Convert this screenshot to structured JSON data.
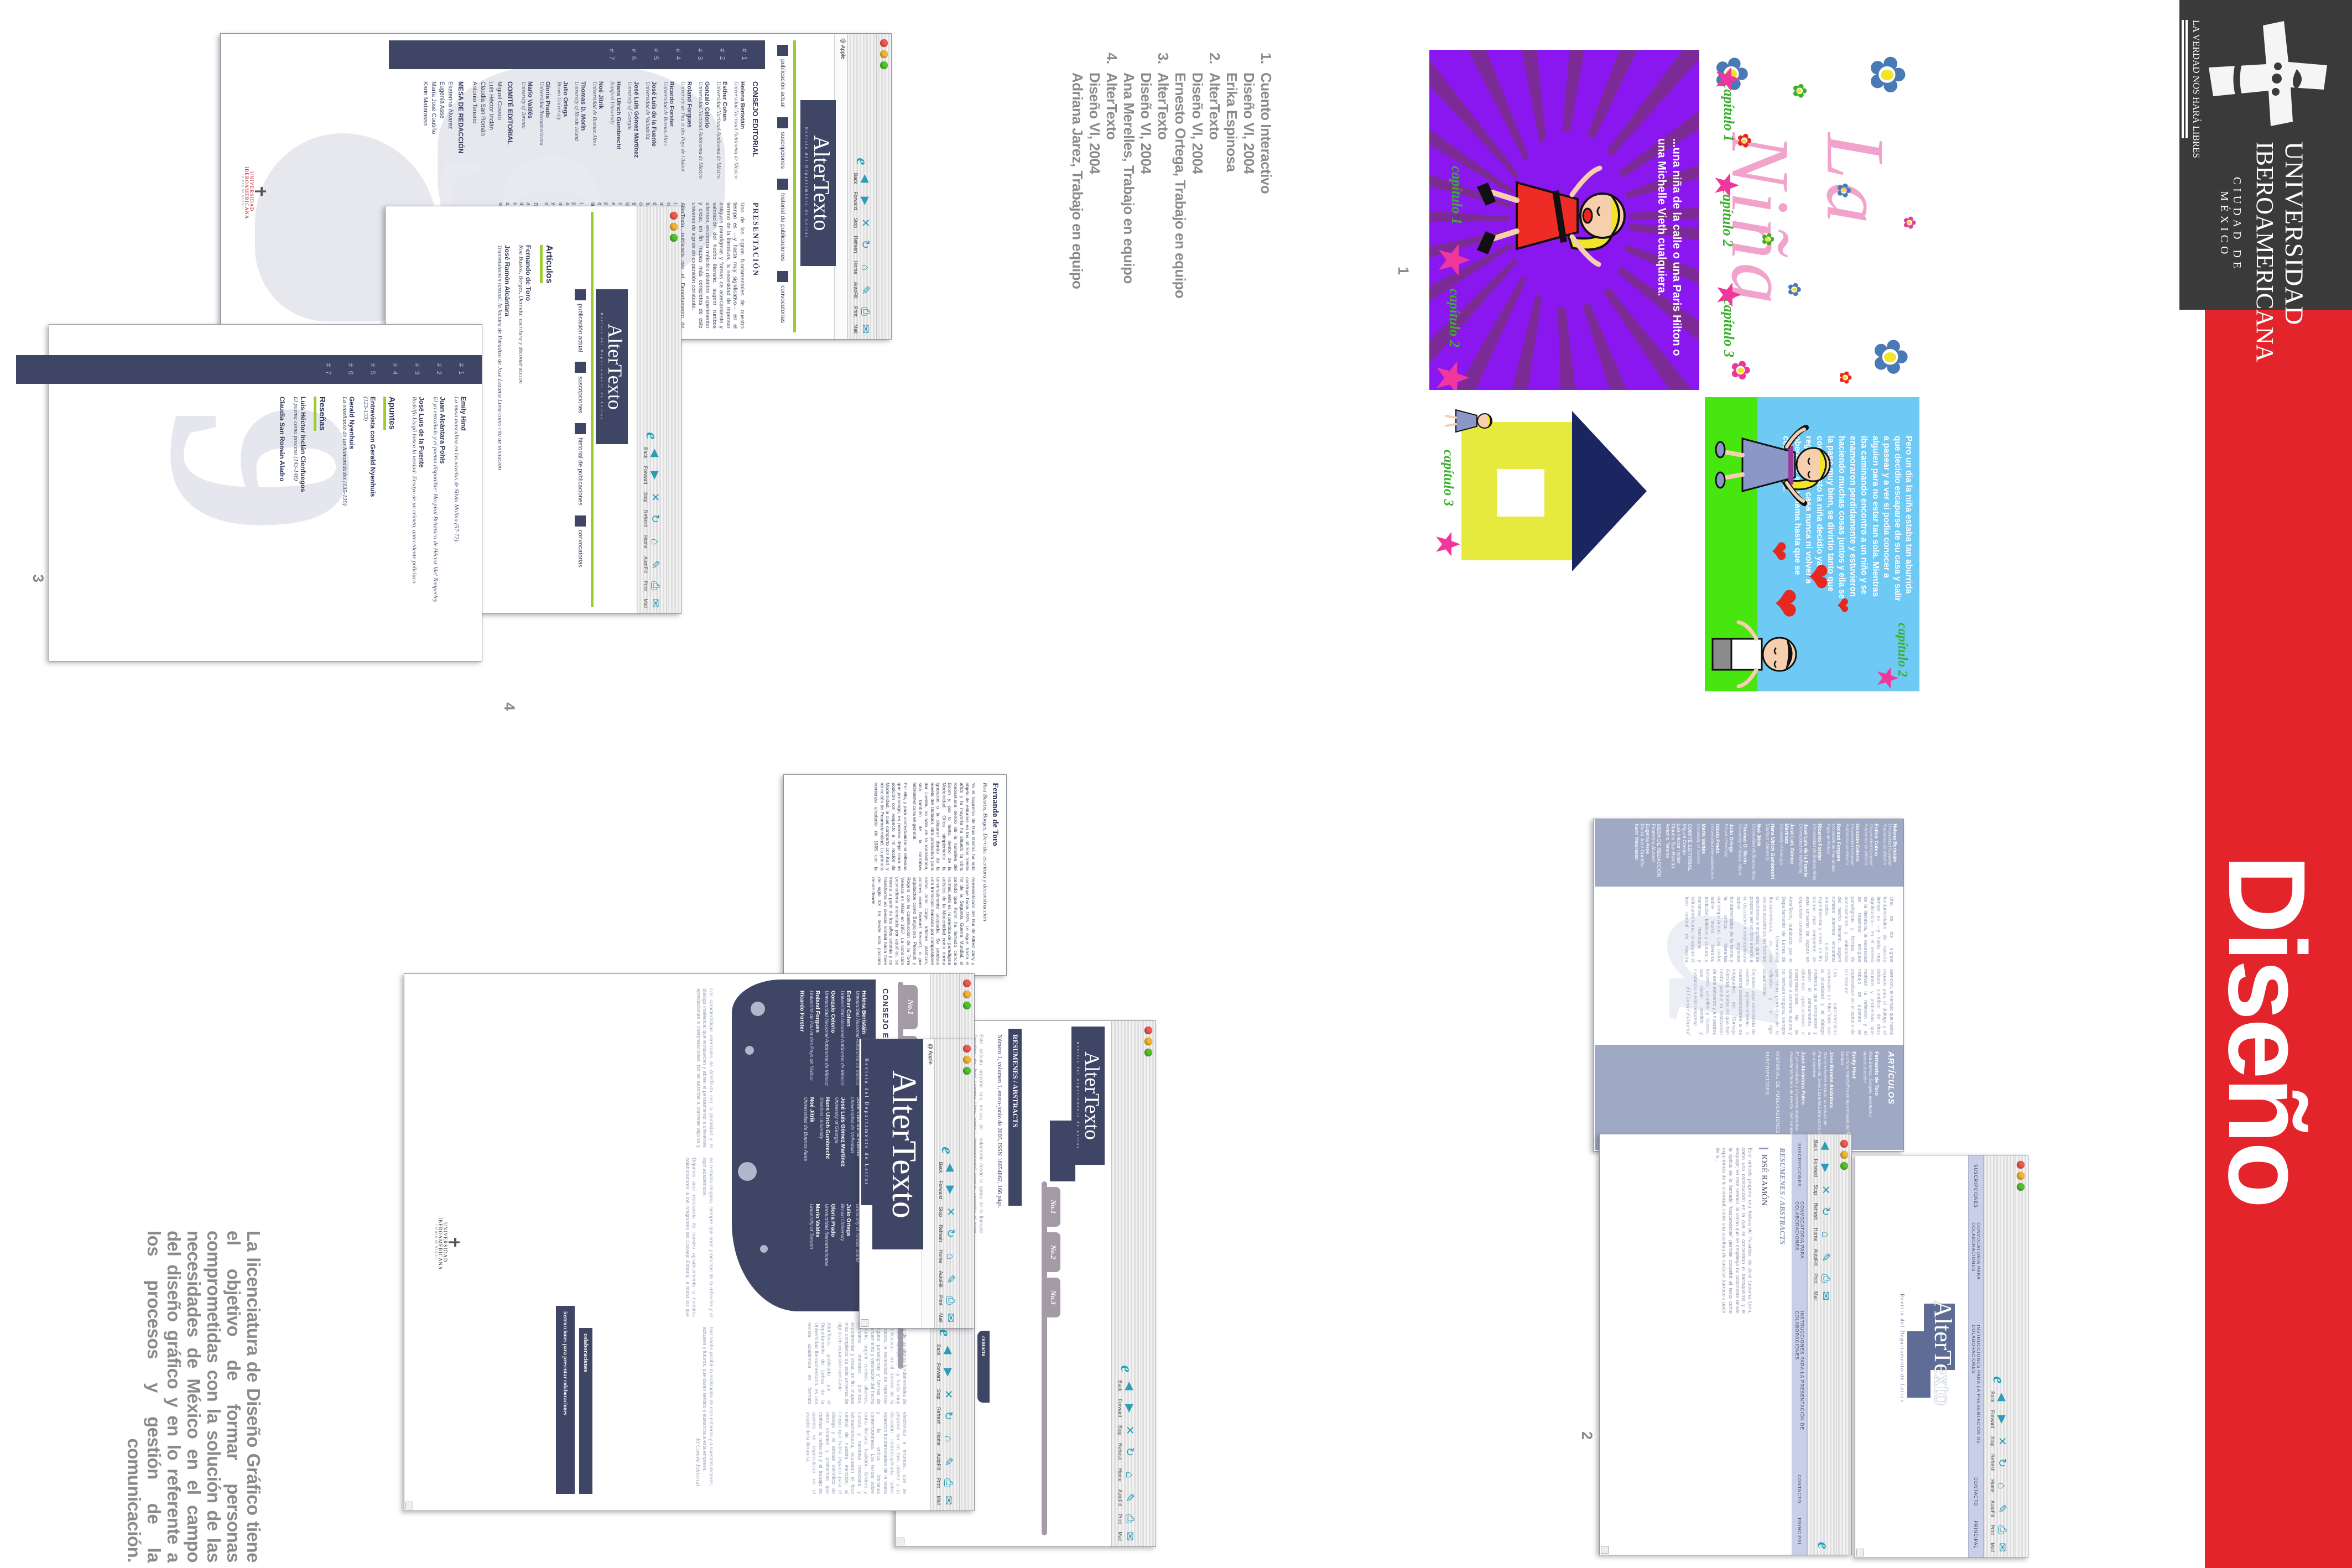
{
  "banner": {
    "motto": "LA VERDAD NOS HARÁ LIBRES",
    "univ1": "UNIVERSIDAD",
    "univ2": "IBEROAMERICANA",
    "city": "CIUDAD DE MÉXICO",
    "title": "Diseño Gráfico",
    "red": "#e3242b",
    "black": "#3a3a3a"
  },
  "markers": {
    "p1": "1",
    "p2": "2",
    "p3": "3",
    "p4": "4"
  },
  "project_list": [
    {
      "n": "1.",
      "t": "Cuento Interactivo"
    },
    {
      "n": "",
      "t": "Diseño VI, 2004"
    },
    {
      "n": "",
      "t": "Erika Espinosa"
    },
    {
      "n": "2.",
      "t": "AlterTexto"
    },
    {
      "n": "",
      "t": "Diseño VI, 2004"
    },
    {
      "n": "",
      "t": "Ernesto Ortega, Trabajo en equipo"
    },
    {
      "n": "3.",
      "t": "AlterTexto"
    },
    {
      "n": "",
      "t": "Diseño VI, 2004"
    },
    {
      "n": "",
      "t": "Ana Merelles, Trabajo en equipo"
    },
    {
      "n": "4.",
      "t": "AlterTexto"
    },
    {
      "n": "",
      "t": "Diseño VI, 2004"
    },
    {
      "n": "",
      "t": "Adriana Jarez, Trabajo en equipo"
    }
  ],
  "footer": "La licenciatura de Diseño Gráfico tiene el objetivo de formar personas comprometidas con la solución de las necesidades de México en el campo del diseño gráfico y en lo referente a los procesos y gestión de la comunicación.",
  "illustrations": {
    "la_nina": {
      "title": "La Niña",
      "chapters": [
        "capítulo 1",
        "capítulo 2",
        "capítulo 3"
      ]
    },
    "purple": {
      "caption": "...una niña de la calle o una Paris Hilton o una Michelle Vieth cualquiera.",
      "chapters": [
        "capítulo 1",
        "capítulo 2"
      ]
    },
    "house": {
      "chapter": "capítulo 3"
    },
    "kids": {
      "chapter": "capítulo 2",
      "story": "Pero un dia la niña estaba tan aburrida que decidio escaparse de su casa y salir a pasear y a ver si podia conocer a alguien para no estar tan sola. Mientras iba caminando encontro a un niño y se enamoraron perdidamente y estuvieron haciendo muchas cosas juntos y ella se la paso muy bien, se divirtio tanto que con todo esto la niña decidio ya no regresar a su casa nunca ni volver a obedecer a su mama hasta que se convirtio en..."
    }
  },
  "browser": {
    "toolbar": [
      {
        "icon": "◀",
        "label": "Back"
      },
      {
        "icon": "▶",
        "label": "Forward"
      },
      {
        "icon": "✕",
        "label": "Stop"
      },
      {
        "icon": "↻",
        "label": "Refresh"
      },
      {
        "icon": "⌂",
        "label": "Home"
      },
      {
        "icon": "✎",
        "label": "AutoFill"
      },
      {
        "icon": "⎙",
        "label": "Print"
      },
      {
        "icon": "✉",
        "label": "Mail"
      }
    ],
    "address": "@ Apple"
  },
  "altertexto": {
    "logo": "AlterTexto",
    "tagline": "Revista del Departamento de Letras",
    "nav": [
      "publicación actual",
      "suscripciones",
      "historial de publicaciones",
      "convocatorias"
    ],
    "issues": [
      "# 1",
      "# 2",
      "# 3",
      "# 4",
      "# 5",
      "# 6",
      "# 7"
    ]
  },
  "consejo": {
    "heading": "CONSEJO EDITORIAL",
    "members": [
      {
        "name": "Helena Beristáin",
        "aff": "Universidad Nacional Autónoma de México"
      },
      {
        "name": "Esther Cohen",
        "aff": "Universidad Nacional Autónoma de México"
      },
      {
        "name": "Gonzalo Celorio",
        "aff": "Universidad Nacional Autónoma de México"
      },
      {
        "name": "Roland Forgues",
        "aff": "Université de Pau et des Pays de l'Adour"
      },
      {
        "name": "Ricardo Forster",
        "aff": "Universidad de Buenos Aires"
      },
      {
        "name": "José Luis de la Fuente",
        "aff": "Universidad de Valladolid"
      },
      {
        "name": "José Luis Gómez Martínez",
        "aff": "University of Georgia"
      },
      {
        "name": "Hans Ulrich Gumbrecht",
        "aff": "Stanford University"
      },
      {
        "name": "Noé Jitrik",
        "aff": "Universidad de Buenos Aires"
      },
      {
        "name": "Thomas D. Morin",
        "aff": "University of Rhode Island"
      },
      {
        "name": "Julio Ortega",
        "aff": "Brown University"
      },
      {
        "name": "Gloria Prado",
        "aff": "Universidad Iberoamericana"
      },
      {
        "name": "Mario Valdés",
        "aff": "University of Toronto"
      }
    ]
  },
  "comite": {
    "heading": "COMITÉ EDITORIAL",
    "members": [
      {
        "name": "Miguel Cossío"
      },
      {
        "name": "Luis Héctor Inclán"
      },
      {
        "name": "Claudia San Román"
      },
      {
        "name": "Antonio Tenorio"
      }
    ]
  },
  "mesa": {
    "heading": "MESA DE REDACCIÓN",
    "members": [
      {
        "name": "Ekaterina Álvarez"
      },
      {
        "name": "Eugenia Asse"
      },
      {
        "name": "María José Coutiño"
      },
      {
        "name": "Karin Matarasso"
      }
    ]
  },
  "presentacion": {
    "heading": "PRESENTACIÓN",
    "p1": "Uno de los signos fundamentales de nuestro tiempo es —y hasta muy significativo— en el terreno de la literatura, la necesidad de repensar antiguos paradigmas y formas de acercamiento y valoración del hecho literario, sugerir rumbos alternos, encontrar métodos distintos, experimentar y crear, en fin, mapas más completos de este universo de signos en expansión constante.",
    "p2": "AlterTexto, publicada por el Departamento de Letras de la Universidad Iberoamericana, es una revista académica en formato electrónico e impreso, que se propone ser un foro abierto a la discusión interdisciplinaria sobre aspectos fundamentales de la teoría y la crítica literarias contemporáneas. Los textos sobre teoría literaria; tradición, folklore y cultura; y narrativa mexicana y latinoamericana, ocuparán el foco central de nuestra atención, al tiempo que habrá espacio para el diálogo y el debate científico de otros asuntos y problemas que motivan la reflexión y el trabajo de quienes se especializan en el estudio de la literatura.",
    "p3": "Las características esenciales de AlterTexto son la pluralidad y el diálogo intelectual que enriquecen y abren el pensamiento a diferentes apreciaciones e interpretaciones. No se adscribe a corriente alguna y no rechaza ninguna, siempre que sean productos de la reflexión y el rigor académicos.",
    "p4": "Dejamos aquí constancia de nuestro agradecimiento a nuestros colaboradores, a los integrantes del Consejo Editorial, a todos los que han hecho posible la realización de este esfuerzo y a nuestros lectores, actuales y futuros, que darán sentido y sustancia a esta empresa.",
    "signature": "El Comité Editorial"
  },
  "toc": {
    "entries": [
      {
        "name": "Emily Hind",
        "title": "La musa masculina en las novelas de Silvia Molina (57-72)"
      },
      {
        "name": "Juan Alcántara Pohls",
        "title": "El yo extrañado y el poema disponible: Hospital Británico de Héctor Viel Temperley"
      },
      {
        "name": "José Luis de la Fuente",
        "title": "Rodolfo Usigli busca la verdad: Ensayo de un crimen, antecedente policiaco"
      }
    ],
    "apuntes_heading": "Apuntes",
    "apuntes": [
      {
        "name": "Entrevista con Gerald Nyenhuis",
        "title": "(123-133)"
      },
      {
        "name": "Gerald Nyenhuis",
        "title": "La enseñanza de las humanidades (135-139)"
      }
    ],
    "resenas_heading": "Reseñas",
    "resenas": [
      {
        "name": "Luis Héctor Inclán Cienfuegos",
        "title": "El poema como proceso (143-148)"
      },
      {
        "name": "Claudia San Román Aladro",
        "title": ""
      }
    ]
  },
  "articulos": {
    "heading": "Artículos",
    "entries": [
      {
        "name": "Fernando de Toro",
        "title": "Roa Bastos, Borges, Derrida: escritura y deconstrucción"
      },
      {
        "name": "José Ramón Alcántara",
        "title": "Transmutación textual: la lectura de Paradiso de José Lezama Lima como rito de iniciación"
      }
    ]
  },
  "articulos2": {
    "heading": "ARTÍCULOS",
    "entries": [
      {
        "name": "Fernando de Toro",
        "title": "Roa Bastos, Borges, escritura y deconstrucción"
      },
      {
        "name": "Emily Hind",
        "title": "La musa masculina en las novelas de Silvia Molina"
      },
      {
        "name": "Jose Ramón Alcántara",
        "title": "Transmutación textual: la lectura de Paradiso de José Lezama Lima como rito de iniciación"
      },
      {
        "name": "Juan Alcántara Pohls",
        "title": "El yo extrañado y el poema disponible Hospital Británico de Héctor Viel Temperley"
      }
    ],
    "historial": "HISTORIAL DE PUBLICACIONES",
    "suscripciones": "SUSCRIPCIONES"
  },
  "article": {
    "author": "Fernando de Toro",
    "subtitle": "Roa Bastos, Borges, Derrida: escritura y deconstrucción",
    "body1": "Yo el Supremo de Roa Bastos ha sido objeto de estudios en los últimos treinta años y la mayoría ha situado la obra roabastiana dentro de la narrativa del Boom y, por lo tanto, dentro de la Modernidad. Otros simplemente la ignoraron o la situaron dentro de la novela del Dictador, otra productiva para dar cuenta, no sólo de la roabastiana, sino también de la narrativa latinoamericana en general.",
    "body2": "Por ello, y para contextualizar la reflexión que propongo, es preciso dejar clara mi posición con respecto a mi noción de Modernidad, la cual comparto con Karl, y mi noción de Posmodernidad. La primera comienza alrededor de 1895 con la representación del Roi de Alfred Jarry y concluye hacia 1925. Le sigue, hasta el fin de la Segunda Guerra Mundial, el periodo que Kuhn ha llamado ciencia normal, esto es, la práctica del paradigma artístico de la Modernidad como norma universalmente aceptada. Se produce una transición marcada por compositores como John Cage, artistas plásticos, autores como Samuel Beckett, o por arquitectos como Belgiojoso, Peresutti y Rogers con la construcción de la Torre Velasca en Milán en 1957. La condición posmoderna anunciada por aquéllos, se inserta a partir de los años setenta y se transforma en ciencia normal hacia fines del siglo XX. Es desde esta posición desde donde..."
  },
  "resumenes": {
    "bar": "RESUMENES / ABSTRACTS",
    "numero": "Número 1, volumen 1, enero-junio de 2003, ISSN 16654862, 166 págs.",
    "tabs": [
      "No.1",
      "No.2",
      "No.3"
    ],
    "contacto": "contacto",
    "entry_name": "JOSÉ RAMÓN",
    "abstract": "Este artículo propone una lectura de Paradiso, de José Lezama Lima, como una construcción en la que se concentran el barroquismo y el lenguaje; en este sentido, la visión que se despliega no solamente desde la óptica de lo llamado “trascendente” permite concebir el texto como experiencia de lo vivencial, como una escritura de carácter barroco a partir de la..."
  },
  "page2menu": [
    "SUSCRIPCIONES",
    "CONVOCATORIA PARA COLABORACIONES",
    "INSTRUCCIONES PARA LA PRESENTACIÓN DE COLABORACIONES",
    "CONTACTO",
    "PRINCIPAL"
  ],
  "page4menu": [
    {
      "name": "colaboraciones"
    },
    {
      "name": "instrucciones para presentar colaboraciones"
    }
  ],
  "uia_mini": {
    "l1": "UNIVERSIDAD",
    "l2": "IBEROAMERICANA",
    "l3": "CIUDAD DE MÉXICO"
  },
  "watermarks": {
    "w1": "a",
    "w2": "9"
  }
}
